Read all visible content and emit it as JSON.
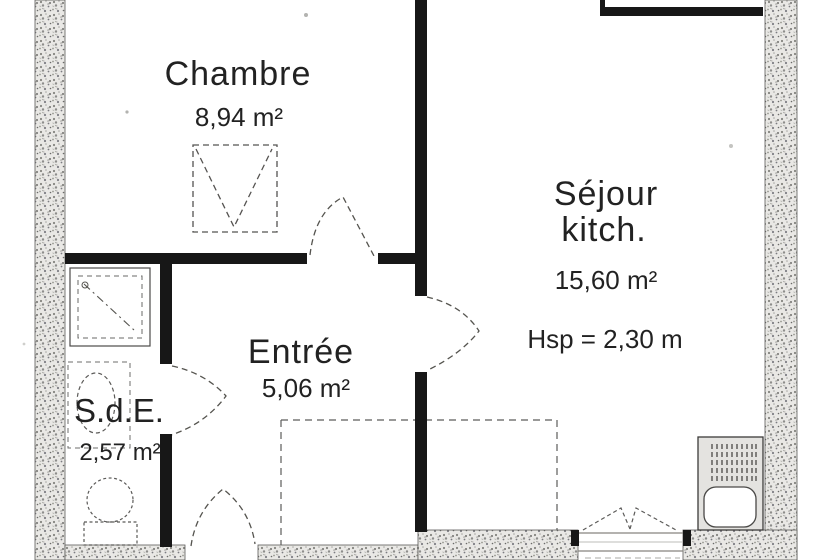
{
  "rooms": {
    "chambre": {
      "name": "Chambre",
      "area": "8,94 m²"
    },
    "sejour": {
      "name_line1": "Séjour",
      "name_line2": "kitch.",
      "area": "15,60 m²",
      "ceiling_height": "Hsp = 2,30 m"
    },
    "entree": {
      "name": "Entrée",
      "area": "5,06 m²"
    },
    "sde": {
      "name": "S.d.E.",
      "area": "2,57 m²"
    }
  },
  "fixtures": {
    "wardrobe": "wardrobe-symbol",
    "shower": "shower-tray-symbol",
    "washbasin": "washbasin-symbol",
    "toilet": "toilet-symbol",
    "kitchen_unit": "kitchen-sink-unit-symbol",
    "window": "casement-window-symbol",
    "doors": [
      "chambre-door-swing",
      "sde-door-swing",
      "sejour-door-swing",
      "entrance-door-swing"
    ],
    "closet": "overhead-closet-dashed-outline"
  },
  "colors": {
    "wall_solid": "#171717",
    "wall_hatch_base": "#e9e8e5",
    "line": "#4a4a48",
    "text": "#222222",
    "background": "#ffffff"
  }
}
